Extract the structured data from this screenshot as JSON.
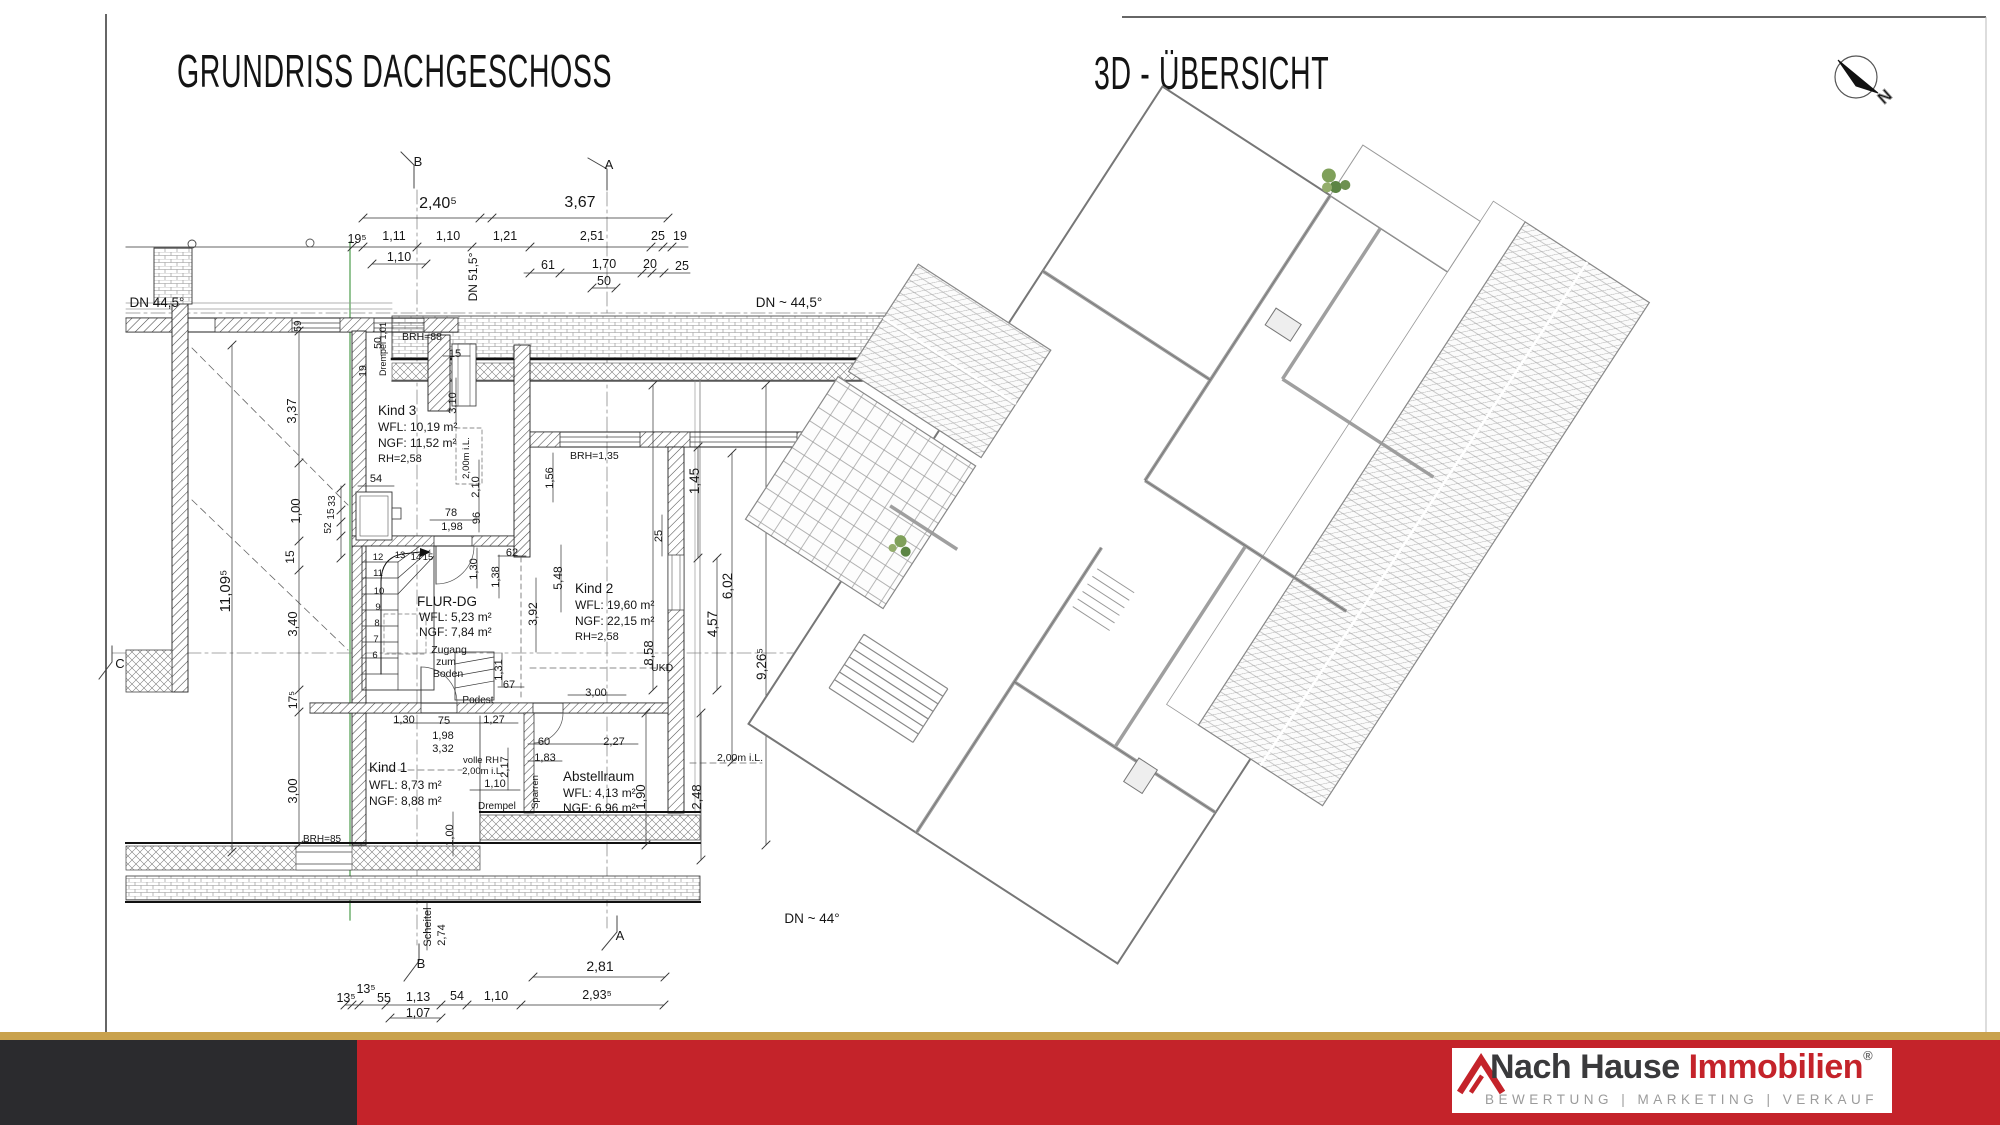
{
  "titles": {
    "plan": "GRUNDRISS  DACHGESCHOSS",
    "overview": "3D - ÜBERSICHT"
  },
  "compass": {
    "label": "N"
  },
  "footer": {
    "brand_name_1": "Nach Hause ",
    "brand_name_2": "Immobilien",
    "registered": "®",
    "tagline": "BEWERTUNG | MARKETING | VERKAUF",
    "colors": {
      "gold": "#c9a24d",
      "dark": "#2b2b2e",
      "red": "#c4232a",
      "brand_dark": "#3a3a3c",
      "brand_red": "#c4232a",
      "tagline_gray": "#9b9b9b"
    }
  },
  "plan": {
    "annotations": [
      {
        "t": "2,40⁵",
        "x": 438,
        "y": 208,
        "s": 16
      },
      {
        "t": "3,67",
        "x": 580,
        "y": 207,
        "s": 16
      },
      {
        "t": "19⁵",
        "x": 357,
        "y": 243,
        "s": 12.5
      },
      {
        "t": "1,11",
        "x": 394,
        "y": 240,
        "s": 12.5
      },
      {
        "t": "1,10",
        "x": 448,
        "y": 240,
        "s": 12.5
      },
      {
        "t": "1,21",
        "x": 505,
        "y": 240,
        "s": 12.5
      },
      {
        "t": "2,51",
        "x": 592,
        "y": 240,
        "s": 12.5
      },
      {
        "t": "25",
        "x": 658,
        "y": 240,
        "s": 12.5
      },
      {
        "t": "19",
        "x": 680,
        "y": 240,
        "s": 12.5
      },
      {
        "t": "1,10",
        "x": 399,
        "y": 261,
        "s": 12.5
      },
      {
        "t": "61",
        "x": 548,
        "y": 269,
        "s": 12.5
      },
      {
        "t": "1,70",
        "x": 604,
        "y": 268,
        "s": 12.5
      },
      {
        "t": "20",
        "x": 650,
        "y": 268,
        "s": 12.5
      },
      {
        "t": "25",
        "x": 682,
        "y": 270,
        "s": 12.5
      },
      {
        "t": "50",
        "x": 604,
        "y": 285,
        "s": 12.5
      },
      {
        "t": "B",
        "x": 418,
        "y": 166,
        "s": 13,
        "n": "section-marker-b-top"
      },
      {
        "t": "A",
        "x": 609,
        "y": 169,
        "s": 13,
        "n": "section-marker-a-top"
      },
      {
        "t": "B",
        "x": 421,
        "y": 968,
        "s": 13,
        "n": "section-marker-b-bottom"
      },
      {
        "t": "A",
        "x": 620,
        "y": 940,
        "s": 13,
        "n": "section-marker-a-bottom"
      },
      {
        "t": "C",
        "x": 120,
        "y": 668,
        "s": 13,
        "n": "section-marker-c-left"
      },
      {
        "t": "C",
        "x": 886,
        "y": 657,
        "s": 13,
        "n": "section-marker-c-right"
      },
      {
        "t": "DN 44,5°",
        "x": 157,
        "y": 307,
        "s": 13.5,
        "n": "roof-pitch-label"
      },
      {
        "t": "DN 51,5°",
        "x": 477,
        "y": 277,
        "r": -90,
        "s": 12,
        "n": "roof-pitch-label"
      },
      {
        "t": "DN ~ 44,5°",
        "x": 789,
        "y": 307,
        "s": 13.5,
        "n": "roof-pitch-label"
      },
      {
        "t": "DN ~ 44°",
        "x": 812,
        "y": 923,
        "s": 13.5,
        "n": "roof-pitch-label"
      },
      {
        "t": "11,09⁵",
        "x": 230,
        "y": 591,
        "r": -90,
        "s": 15
      },
      {
        "t": "3,37",
        "x": 296,
        "y": 411,
        "r": -90,
        "s": 13
      },
      {
        "t": "1,00",
        "x": 300,
        "y": 511,
        "r": -90,
        "s": 13
      },
      {
        "t": "15",
        "x": 294,
        "y": 557,
        "r": -90,
        "s": 12
      },
      {
        "t": "3,40",
        "x": 297,
        "y": 624,
        "r": -90,
        "s": 13
      },
      {
        "t": "17⁵",
        "x": 297,
        "y": 700,
        "r": -90,
        "s": 12
      },
      {
        "t": "3,00",
        "x": 297,
        "y": 791,
        "r": -90,
        "s": 13
      },
      {
        "t": "59",
        "x": 301,
        "y": 326,
        "r": -90,
        "s": 10
      },
      {
        "t": "19",
        "x": 366,
        "y": 371,
        "r": -90,
        "s": 10.5
      },
      {
        "t": "50",
        "x": 381,
        "y": 343,
        "r": -90,
        "s": 10.5
      },
      {
        "t": "BRH=88",
        "x": 402,
        "y": 340,
        "a": "start",
        "s": 10.5
      },
      {
        "t": "Drempel 1,01",
        "x": 386,
        "y": 349,
        "r": -90,
        "s": 9
      },
      {
        "t": "15",
        "x": 455,
        "y": 357,
        "s": 11
      },
      {
        "t": "3,10",
        "x": 456,
        "y": 403,
        "r": -90,
        "s": 11
      },
      {
        "t": "2,00m i.L.",
        "x": 469,
        "y": 458,
        "r": -90,
        "s": 9.5
      },
      {
        "t": "Kind 3",
        "x": 378,
        "y": 415,
        "a": "start",
        "s": 13.5,
        "n": "room-name"
      },
      {
        "t": "WFL: 10,19 m²",
        "x": 378,
        "y": 431,
        "a": "start",
        "s": 12,
        "n": "room-area"
      },
      {
        "t": "NGF: 11,52 m²",
        "x": 378,
        "y": 447,
        "a": "start",
        "s": 12,
        "n": "room-area"
      },
      {
        "t": "RH=2,58",
        "x": 378,
        "y": 462,
        "a": "start",
        "s": 11,
        "n": "room-height"
      },
      {
        "t": "54",
        "x": 376,
        "y": 482,
        "s": 11
      },
      {
        "t": "33",
        "x": 335,
        "y": 501,
        "r": -90,
        "s": 10
      },
      {
        "t": "15",
        "x": 334,
        "y": 514,
        "r": -90,
        "s": 10
      },
      {
        "t": "52",
        "x": 331,
        "y": 528,
        "r": -90,
        "s": 10
      },
      {
        "t": "2,10",
        "x": 479,
        "y": 487,
        "r": -90,
        "s": 11
      },
      {
        "t": "96",
        "x": 480,
        "y": 518,
        "r": -90,
        "s": 11
      },
      {
        "t": "78",
        "x": 451,
        "y": 516,
        "s": 11
      },
      {
        "t": "1,98",
        "x": 452,
        "y": 530,
        "s": 11
      },
      {
        "t": "62",
        "x": 512,
        "y": 556,
        "s": 11
      },
      {
        "t": "1,30",
        "x": 477,
        "y": 569,
        "r": -90,
        "s": 11
      },
      {
        "t": "1,38",
        "x": 499,
        "y": 577,
        "r": -90,
        "s": 11
      },
      {
        "t": "12",
        "x": 378,
        "y": 560,
        "s": 9.5,
        "n": "stair-step-number"
      },
      {
        "t": "13",
        "x": 400,
        "y": 558,
        "s": 9.5,
        "n": "stair-step-number"
      },
      {
        "t": "14",
        "x": 416,
        "y": 560,
        "s": 9.5,
        "n": "stair-step-number"
      },
      {
        "t": "15",
        "x": 428,
        "y": 560,
        "s": 9.5,
        "n": "stair-step-number"
      },
      {
        "t": "11",
        "x": 378,
        "y": 576,
        "s": 9.5,
        "n": "stair-step-number"
      },
      {
        "t": "10",
        "x": 379,
        "y": 594,
        "s": 9.5,
        "n": "stair-step-number"
      },
      {
        "t": "9",
        "x": 378,
        "y": 610,
        "s": 9.5,
        "n": "stair-step-number"
      },
      {
        "t": "8",
        "x": 377,
        "y": 626,
        "s": 9.5,
        "n": "stair-step-number"
      },
      {
        "t": "7",
        "x": 376,
        "y": 642,
        "s": 9.5,
        "n": "stair-step-number"
      },
      {
        "t": "6",
        "x": 375,
        "y": 658,
        "s": 9.5,
        "n": "stair-step-number"
      },
      {
        "t": "FLUR-DG",
        "x": 417,
        "y": 606,
        "a": "start",
        "s": 13.5,
        "n": "room-name"
      },
      {
        "t": "WFL: 5,23 m²",
        "x": 419,
        "y": 621,
        "a": "start",
        "s": 12,
        "n": "room-area"
      },
      {
        "t": "NGF: 7,84 m²",
        "x": 419,
        "y": 636,
        "a": "start",
        "s": 12,
        "n": "room-area"
      },
      {
        "t": "Zugang",
        "x": 449,
        "y": 653,
        "s": 10.5
      },
      {
        "t": "zum",
        "x": 446,
        "y": 665,
        "s": 10.5
      },
      {
        "t": "Boden",
        "x": 448,
        "y": 677,
        "s": 10.5
      },
      {
        "t": "Kind 2",
        "x": 575,
        "y": 593,
        "a": "start",
        "s": 13.5,
        "n": "room-name"
      },
      {
        "t": "WFL: 19,60 m²",
        "x": 575,
        "y": 609,
        "a": "start",
        "s": 12,
        "n": "room-area"
      },
      {
        "t": "NGF: 22,15 m²",
        "x": 575,
        "y": 625,
        "a": "start",
        "s": 12,
        "n": "room-area"
      },
      {
        "t": "RH=2,58",
        "x": 575,
        "y": 640,
        "a": "start",
        "s": 11,
        "n": "room-height"
      },
      {
        "t": "BRH=1,35",
        "x": 570,
        "y": 459,
        "a": "start",
        "s": 10.5
      },
      {
        "t": "1,56",
        "x": 553,
        "y": 478,
        "r": -90,
        "s": 11
      },
      {
        "t": "25",
        "x": 662,
        "y": 536,
        "r": -90,
        "s": 11
      },
      {
        "t": "5,48",
        "x": 562,
        "y": 578,
        "r": -90,
        "s": 12
      },
      {
        "t": "3,92",
        "x": 537,
        "y": 614,
        "r": -90,
        "s": 12
      },
      {
        "t": "1,45",
        "x": 699,
        "y": 481,
        "r": -90,
        "s": 13.5
      },
      {
        "t": "4,57",
        "x": 717,
        "y": 624,
        "r": -90,
        "s": 13.5
      },
      {
        "t": "6,02",
        "x": 732,
        "y": 586,
        "r": -90,
        "s": 13.5
      },
      {
        "t": "8,58",
        "x": 653,
        "y": 653,
        "r": -90,
        "s": 13
      },
      {
        "t": "9,26⁵",
        "x": 766,
        "y": 664,
        "r": -90,
        "s": 13.5
      },
      {
        "t": "UKD",
        "x": 651,
        "y": 671,
        "a": "start",
        "s": 10.5
      },
      {
        "t": "1,31",
        "x": 502,
        "y": 670,
        "r": -90,
        "s": 11
      },
      {
        "t": "67",
        "x": 509,
        "y": 688,
        "s": 11
      },
      {
        "t": "Podest",
        "x": 478,
        "y": 703,
        "s": 10
      },
      {
        "t": "3,00",
        "x": 596,
        "y": 696,
        "s": 11
      },
      {
        "t": "1,30",
        "x": 404,
        "y": 723,
        "s": 11
      },
      {
        "t": "75",
        "x": 444,
        "y": 724,
        "s": 11
      },
      {
        "t": "1,27",
        "x": 494,
        "y": 723,
        "s": 11
      },
      {
        "t": "1,98",
        "x": 443,
        "y": 739,
        "s": 11
      },
      {
        "t": "3,32",
        "x": 443,
        "y": 752,
        "s": 11
      },
      {
        "t": "60",
        "x": 544,
        "y": 745,
        "s": 11
      },
      {
        "t": "2,27",
        "x": 614,
        "y": 745,
        "s": 11
      },
      {
        "t": "1,83",
        "x": 545,
        "y": 761,
        "s": 11
      },
      {
        "t": "volle RH",
        "x": 481,
        "y": 763,
        "s": 9.5
      },
      {
        "t": "2,00m i.L.",
        "x": 483,
        "y": 774,
        "s": 9.5
      },
      {
        "t": "2,17",
        "x": 508,
        "y": 767,
        "r": -90,
        "s": 11
      },
      {
        "t": "1,10",
        "x": 495,
        "y": 787,
        "s": 11
      },
      {
        "t": "Drempel",
        "x": 478,
        "y": 809,
        "a": "start",
        "s": 10
      },
      {
        "t": "Sparren",
        "x": 538,
        "y": 792,
        "r": -90,
        "s": 9.5
      },
      {
        "t": "2,00m i.L.",
        "x": 740,
        "y": 761,
        "s": 10.5
      },
      {
        "t": "1,90",
        "x": 645,
        "y": 797,
        "r": -90,
        "s": 13
      },
      {
        "t": "2,48",
        "x": 701,
        "y": 797,
        "r": -90,
        "s": 13
      },
      {
        "t": "Kind 1",
        "x": 369,
        "y": 772,
        "a": "start",
        "s": 13.5,
        "n": "room-name"
      },
      {
        "t": "WFL: 8,73 m²",
        "x": 369,
        "y": 789,
        "a": "start",
        "s": 12,
        "n": "room-area"
      },
      {
        "t": "NGF: 8,88 m²",
        "x": 369,
        "y": 805,
        "a": "start",
        "s": 12,
        "n": "room-area"
      },
      {
        "t": "Abstellraum",
        "x": 563,
        "y": 781,
        "a": "start",
        "s": 13.5,
        "n": "room-name"
      },
      {
        "t": "WFL: 4,13 m²",
        "x": 563,
        "y": 797,
        "a": "start",
        "s": 12,
        "n": "room-area"
      },
      {
        "t": "NGF: 6,96 m²",
        "x": 563,
        "y": 812,
        "a": "start",
        "s": 12,
        "n": "room-area"
      },
      {
        "t": "1,00",
        "x": 453,
        "y": 835,
        "r": -90,
        "s": 11
      },
      {
        "t": "BRH=85",
        "x": 303,
        "y": 842,
        "a": "start",
        "s": 10
      },
      {
        "t": "Scheitel",
        "x": 431,
        "y": 927,
        "r": -90,
        "s": 11
      },
      {
        "t": "2,74",
        "x": 445,
        "y": 935,
        "r": -90,
        "s": 11
      },
      {
        "t": "2,81",
        "x": 600,
        "y": 971,
        "s": 14
      },
      {
        "t": "13⁵",
        "x": 346,
        "y": 1002,
        "s": 12.5
      },
      {
        "t": "13⁵",
        "x": 366,
        "y": 993,
        "s": 12.5
      },
      {
        "t": "55",
        "x": 384,
        "y": 1002,
        "s": 12.5
      },
      {
        "t": "1,13",
        "x": 418,
        "y": 1001,
        "s": 12.5
      },
      {
        "t": "54",
        "x": 457,
        "y": 1000,
        "s": 12.5
      },
      {
        "t": "1,10",
        "x": 496,
        "y": 1000,
        "s": 12.5
      },
      {
        "t": "2,93⁵",
        "x": 597,
        "y": 999,
        "s": 12.5
      },
      {
        "t": "1,07",
        "x": 418,
        "y": 1017,
        "s": 12.5
      }
    ]
  }
}
